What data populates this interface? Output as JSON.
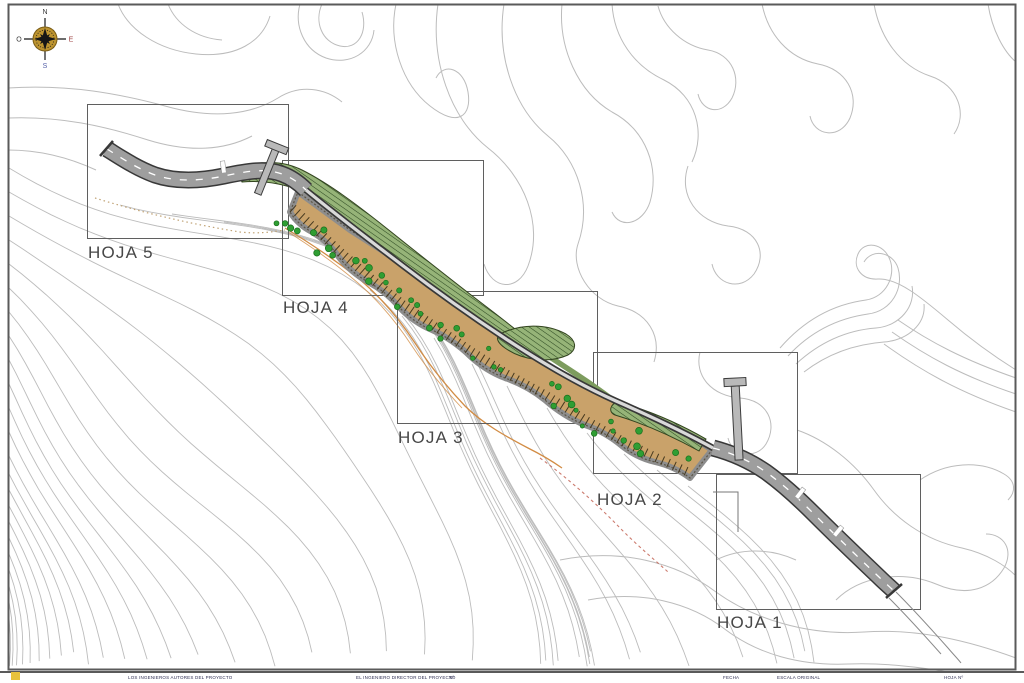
{
  "drawing_title": "Plano de planta - distribucion de hojas",
  "sheets": [
    {
      "label": "HOJA 1",
      "x": 716,
      "y": 474,
      "w": 204,
      "h": 135,
      "label_x": 717,
      "label_y": 628
    },
    {
      "label": "HOJA 2",
      "x": 593,
      "y": 352,
      "w": 204,
      "h": 121,
      "label_x": 597,
      "label_y": 505
    },
    {
      "label": "HOJA 3",
      "x": 397,
      "y": 291,
      "w": 200,
      "h": 132,
      "label_x": 398,
      "label_y": 443
    },
    {
      "label": "HOJA 4",
      "x": 282,
      "y": 160,
      "w": 201,
      "h": 135,
      "label_x": 283,
      "label_y": 313
    },
    {
      "label": "HOJA 5",
      "x": 87,
      "y": 104,
      "w": 201,
      "h": 134,
      "label_x": 88,
      "label_y": 258
    }
  ],
  "compass": {
    "north": "N",
    "south": "S",
    "east": "E",
    "west": "O"
  },
  "title_block": {
    "segments": [
      {
        "x": 128,
        "text": "LOS INGENIEROS AUTORES DEL PROYECTO"
      },
      {
        "x": 356,
        "text": "EL INGENIERO DIRECTOR DEL PROYECTO"
      },
      {
        "x": 449,
        "text": "Nº"
      },
      {
        "x": 723,
        "text": "FECHA"
      },
      {
        "x": 777,
        "text": "ESCALA ORIGINAL"
      },
      {
        "x": 944,
        "text": "HOJA Nº"
      }
    ]
  },
  "colors": {
    "paper": "#ffffff",
    "frame": "#5a5a5a",
    "contour": "#bcbcbc",
    "box_line": "#5f5f5f",
    "sheet_label": "#474747",
    "road_fill": "#9e9e9e",
    "road_edge": "#383838",
    "road_light": "#d9d9d9",
    "road_dash": "#ffffff",
    "corridor_fill": "#c9a26a",
    "corridor_edge": "#8d8d8d",
    "corridor_edge_dark": "#5c5546",
    "slope_hatch": "#46391f",
    "tree_fill": "#2f9e33",
    "tree_edge": "#1a6f1d",
    "veg_fill": "#96b478",
    "veg_hatch": "#2e4a22",
    "veg_edge": "#33441f",
    "trail_orange": "#d28c44",
    "trail_dotted": "#c0a274",
    "red_dash": "#bf5a4a",
    "structure_fill": "#b9b9b9",
    "structure_edge": "#3c3c3c",
    "compass_gold": "#bd9430",
    "compass_dark": "#161616",
    "compass_letter": "#3a3a3a",
    "compass_letter_e": "#a04848",
    "compass_letter_s": "#5560a8",
    "corner_mark": "#e7c23c",
    "title_text": "#2e2e52"
  }
}
